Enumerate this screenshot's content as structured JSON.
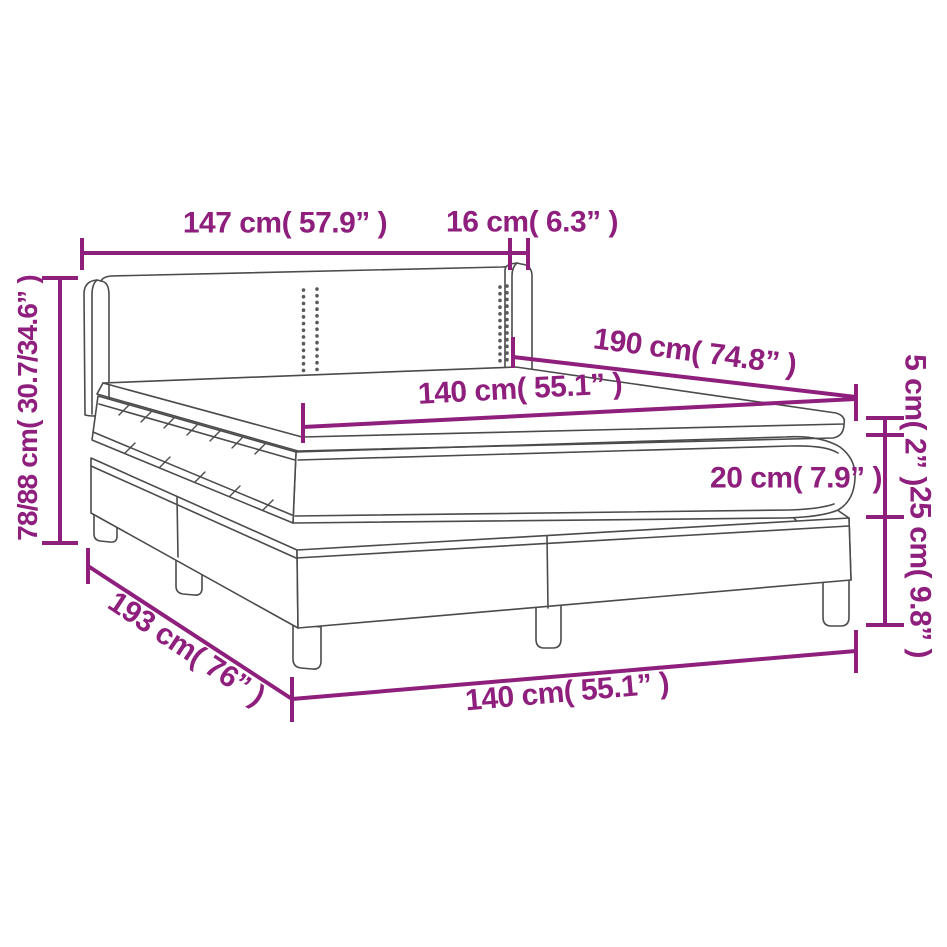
{
  "diagram": {
    "type": "product-dimension-diagram",
    "product": "box spring bed with headboard, mattress and topper",
    "colors": {
      "dimension_accent": "#8F1F7D",
      "line_art": "#4B4B4B",
      "background": "#FFFFFF"
    },
    "dimensions": {
      "headboard_width": "147 cm( 57.9” )",
      "headboard_depth": "16 cm( 6.3” )",
      "total_height": "78/88 cm( 30.7/34.6” )",
      "bed_length": "190 cm( 74.8” )",
      "mattress_width": "140 cm( 55.1” )",
      "topper_height": "5 cm( 2” )",
      "mattress_height": "20 cm( 7.9” )",
      "base_height": "25 cm( 9.8” )",
      "total_length": "193 cm( 76” )",
      "base_width": "140 cm( 55.1” )"
    }
  }
}
